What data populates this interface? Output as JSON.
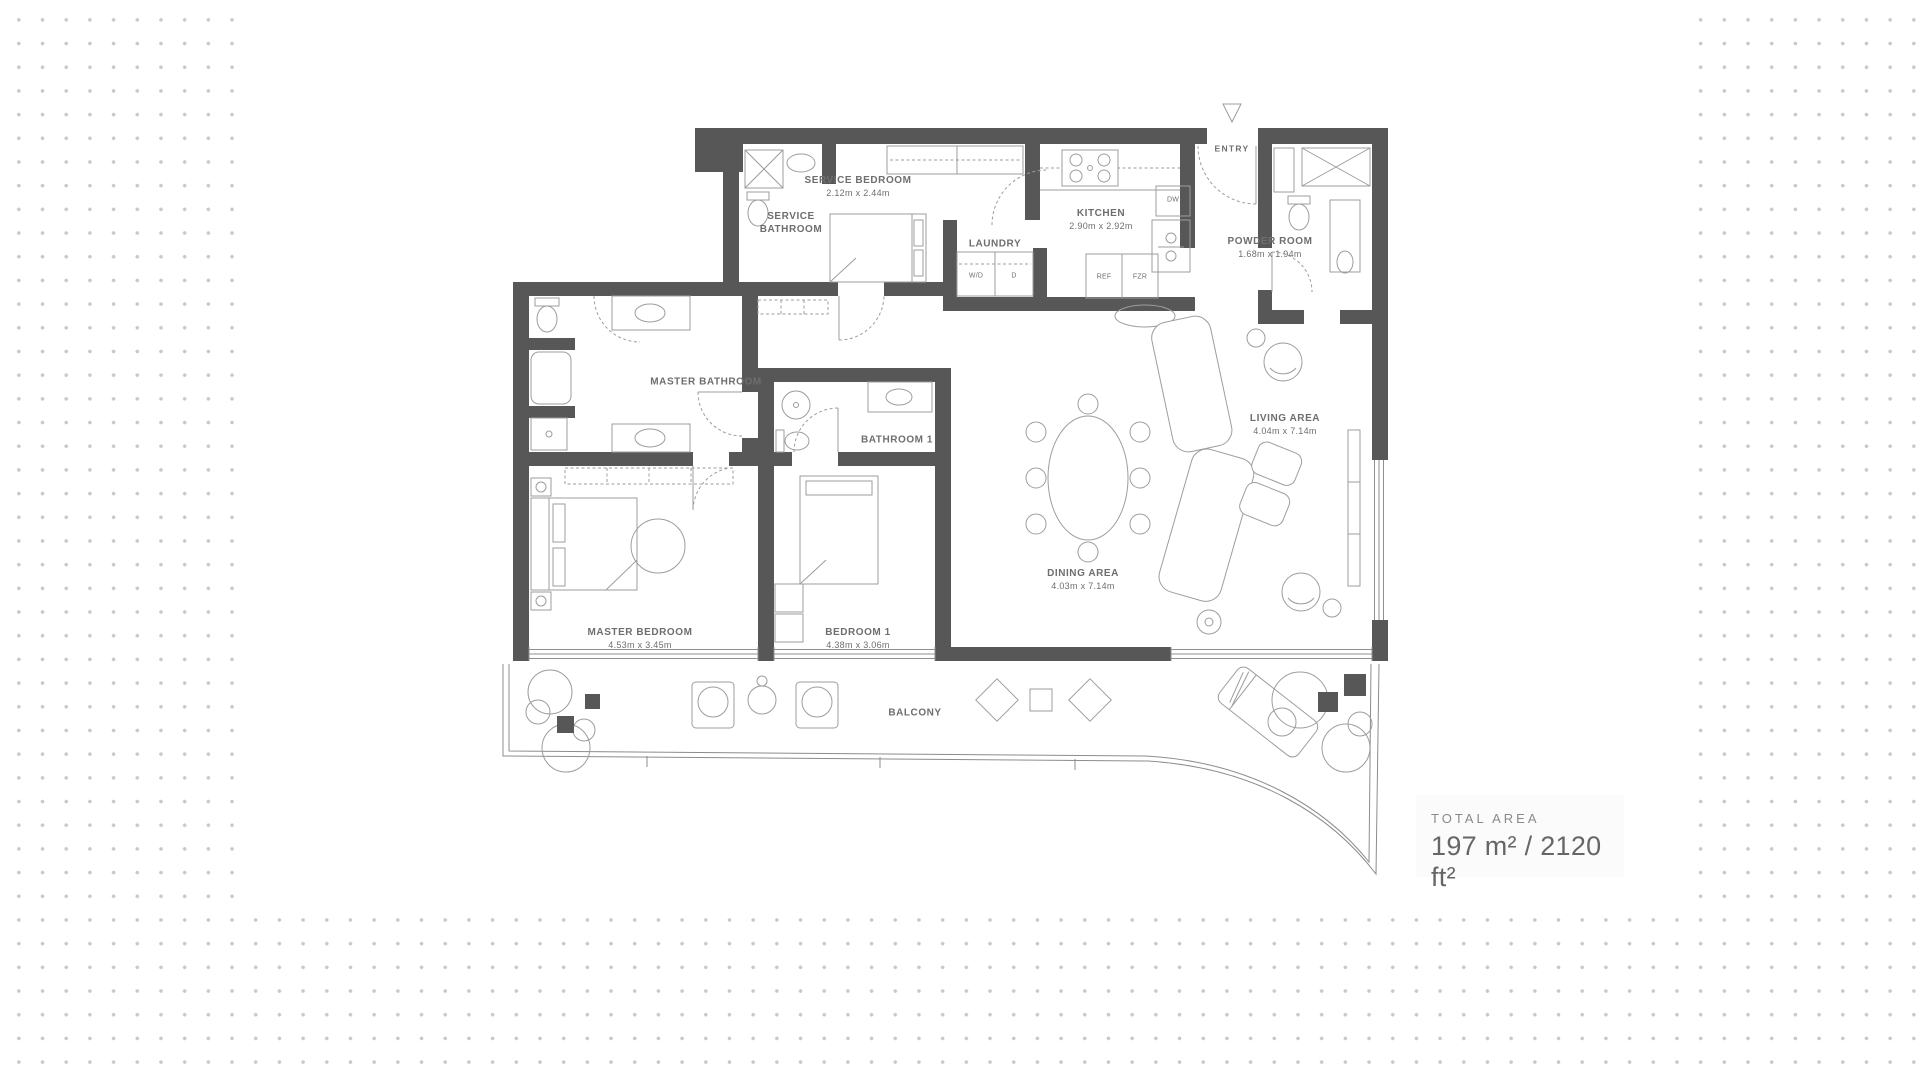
{
  "plan": {
    "entry": {
      "label": "ENTRY"
    },
    "rooms": {
      "service_bedroom": {
        "name": "SERVICE BEDROOM",
        "dims": "2.12m x 2.44m"
      },
      "service_bathroom": {
        "line1": "SERVICE",
        "line2": "BATHROOM"
      },
      "kitchen": {
        "name": "KITCHEN",
        "dims": "2.90m x 2.92m"
      },
      "laundry": {
        "name": "LAUNDRY"
      },
      "powder_room": {
        "name": "POWDER ROOM",
        "dims": "1.68m x 1.94m"
      },
      "master_bathroom": {
        "name": "MASTER BATHROOM"
      },
      "bathroom_1": {
        "name": "BATHROOM 1"
      },
      "master_bedroom": {
        "name": "MASTER BEDROOM",
        "dims": "4.53m x 3.45m"
      },
      "bedroom_1": {
        "name": "BEDROOM 1",
        "dims": "4.38m x 3.06m"
      },
      "dining_area": {
        "name": "DINING AREA",
        "dims": "4.03m x 7.14m"
      },
      "living_area": {
        "name": "LIVING AREA",
        "dims": "4.04m x 7.14m"
      },
      "balcony": {
        "name": "BALCONY"
      }
    },
    "appliances": {
      "washer_dryer": "W/D",
      "dryer": "D",
      "refrigerator": "REF",
      "freezer": "FZR",
      "dishwasher": "DW"
    }
  },
  "summary": {
    "label": "TOTAL AREA",
    "value": "197 m² / 2120 ft²"
  },
  "colors": {
    "wall": "#575757",
    "line": "#9d9d9d",
    "text": "#6e6e6e",
    "dot": "#c8c8c8"
  }
}
